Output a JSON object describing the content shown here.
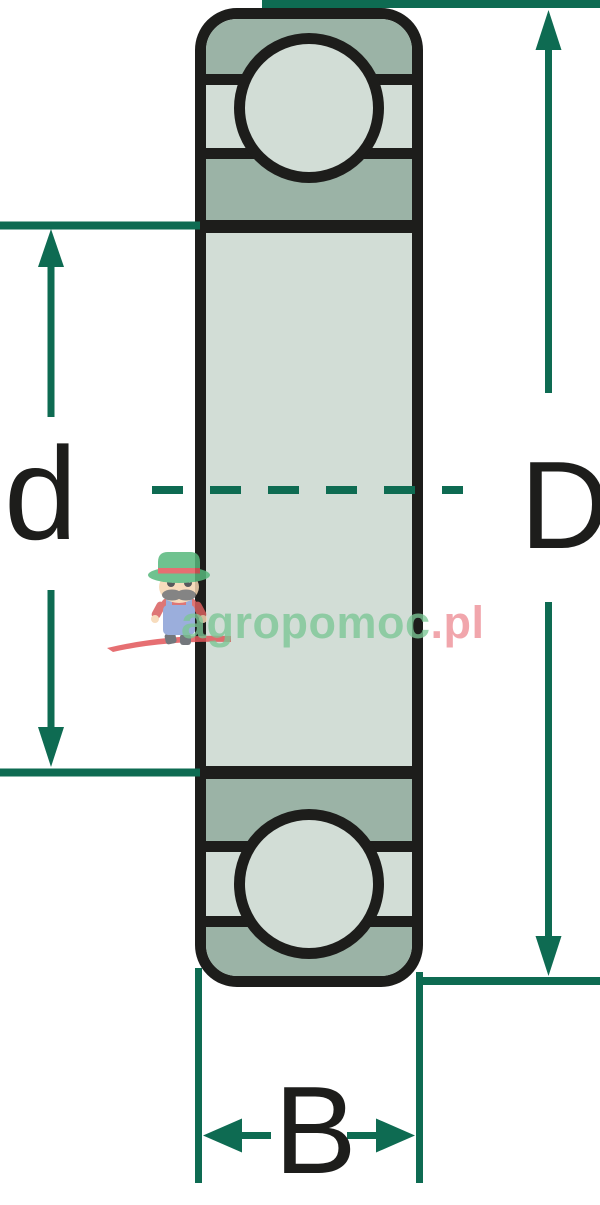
{
  "diagram": {
    "description": "ball-bearing-cross-section-dimension-diagram",
    "labels": {
      "bore_diameter": "d",
      "outer_diameter": "D",
      "width": "B"
    },
    "colors": {
      "dimension_line": "#0e6b52",
      "outline": "#1d1d1b",
      "ring_dark": "#9bb3a6",
      "ring_light": "#d2ddd6",
      "background": "#ffffff"
    }
  },
  "watermark": {
    "brand_full": "agropomoc.pl",
    "brand_green_part": "agropomoc",
    "brand_red_part": ".pl",
    "green": "#7cc795",
    "red": "#ee8e96",
    "mascot": "farmer-mascot-icon"
  }
}
